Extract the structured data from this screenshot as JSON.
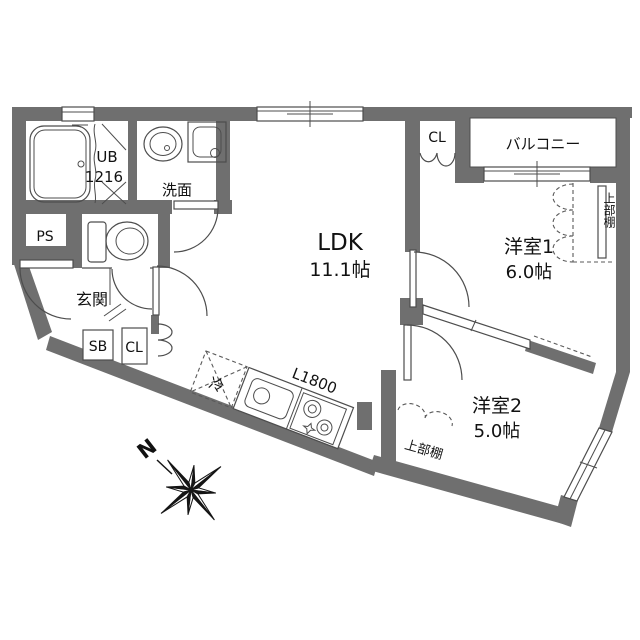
{
  "rooms": {
    "ldk": {
      "name": "LDK",
      "size": "11.1帖"
    },
    "bedroom1": {
      "name": "洋室1",
      "size": "6.0帖"
    },
    "bedroom2": {
      "name": "洋室2",
      "size": "5.0帖"
    },
    "balcony": {
      "name": "バルコニー"
    },
    "entrance": {
      "name": "玄関"
    },
    "washroom": {
      "name": "洗面"
    },
    "unit_bath": {
      "name": "UB",
      "size": "1216"
    }
  },
  "labels": {
    "pipe_space": "PS",
    "shoe_box": "SB",
    "closet_entrance": "CL",
    "closet_ldk": "CL",
    "upper_shelf_bedroom1": "上部棚",
    "upper_shelf_bedroom2": "上部棚",
    "refrigerator": "冷",
    "kitchen_counter_length": "L1800",
    "compass_north": "N"
  },
  "colors": {
    "wall": "#6f6f6f",
    "line": "#4d4d4d",
    "text": "#111111",
    "background": "#ffffff"
  }
}
